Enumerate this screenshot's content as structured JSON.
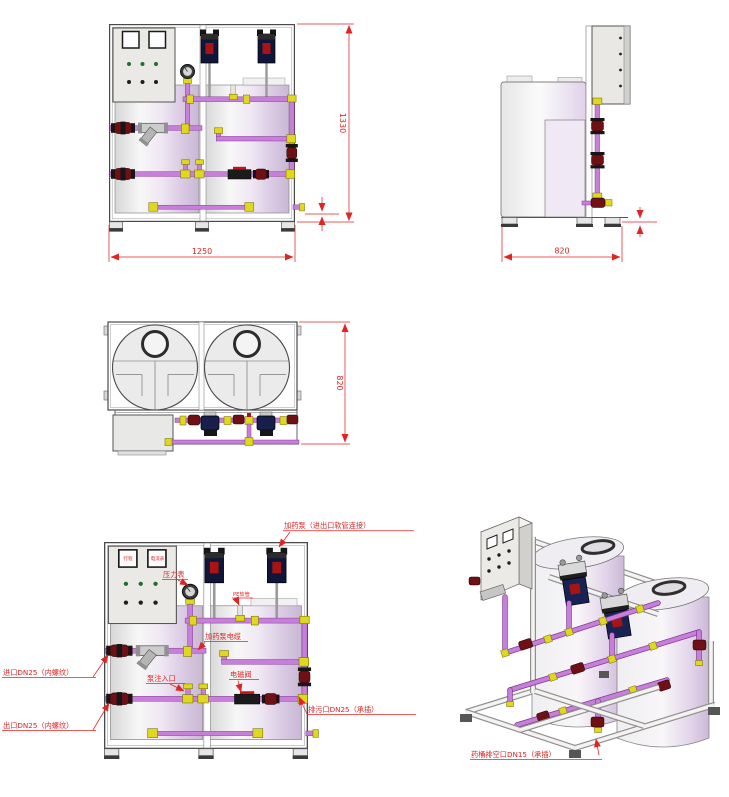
{
  "palette": {
    "annotation_red": "#e02424",
    "line_gray": "#555555",
    "pipe_purple": "#c77fd9",
    "fitting_yellow": "#ded81f",
    "valve_maroon": "#6e1014",
    "pump_navy": "#10163a",
    "pump_display_red": "#a81414",
    "tank_lavender": "#d9c9e2",
    "panel_gray": "#ebe9e5",
    "indicator_green": "#1d6f2b"
  },
  "front_view": {
    "dim_height": "1330",
    "dim_width": "1250"
  },
  "side_view": {
    "dim_width": "820"
  },
  "top_view": {
    "dim_depth": "820"
  },
  "annotated_view": {
    "panel_label_left": "行程",
    "panel_label_right": "电流表",
    "label_dosing_pump": "加药泵（进出口软管连接）",
    "label_pressure_gauge": "压力表",
    "label_pe_hose": "PE软管",
    "label_pump_cable": "加药泵电缆",
    "label_pump_inlet": "泵注入口",
    "label_solenoid_valve": "电磁阀",
    "label_drain_port": "排污口DN25（承插）",
    "label_inlet_port": "进口DN25（内螺纹）",
    "label_outlet_port": "出口DN25（内螺纹）"
  },
  "isometric_view": {
    "label_tank_empty_port": "药桶排空口DN15（承插）"
  }
}
